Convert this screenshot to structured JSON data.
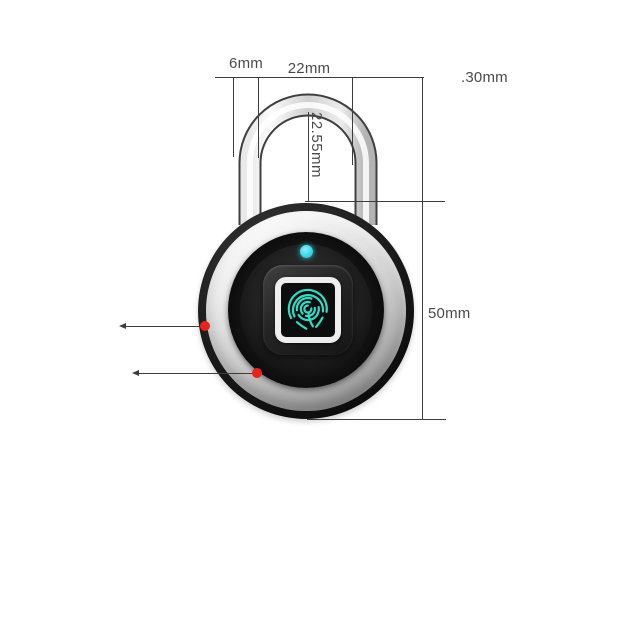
{
  "page": {
    "description": "Product dimension diagram of a smart fingerprint padlock on white background"
  },
  "dimension_labels": {
    "shackle_wire_diameter": "6mm",
    "shackle_inner_width": "22mm",
    "shackle_height": ".30mm",
    "shackle_inner_height": "22.55mm",
    "body_height": "50mm"
  },
  "colors": {
    "fingerprint_icon": "#2edcc8",
    "led_indicator": "#3bd8e8",
    "callout_marker": "#e7231c",
    "dimension_line": "#3d3d3d",
    "label_text": "#4a4a4a",
    "body_chrome": "#d6d6d6",
    "body_face": "#161616"
  }
}
